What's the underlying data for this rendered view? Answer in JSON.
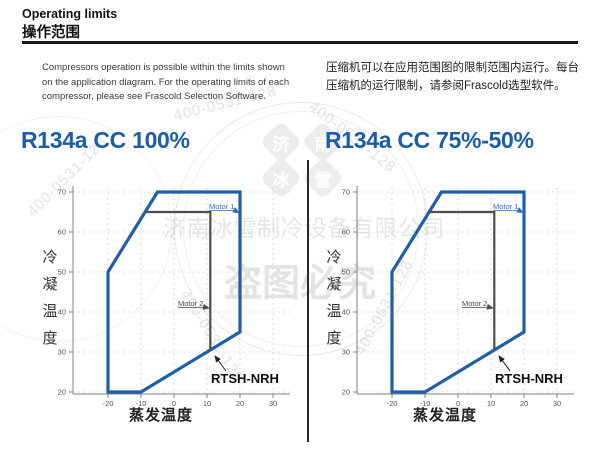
{
  "header": {
    "title_en": "Operating limits",
    "title_zh": "操作范围"
  },
  "intro": {
    "en": "Compressors operation is possible within the limits shown on the application diagram. For the operating limits of each compressor, please see Frascold Selection Software.",
    "zh": "压缩机可以在应用范围图的限制范围内运行。每台压缩机的运行限制，请参阅Frascold选型软件。"
  },
  "watermark": {
    "company": "济南冰雪制冷设备有限公司",
    "phone": "400-0531-128",
    "warning": "盗图必究",
    "logo_chars": [
      "济",
      "南",
      "冰",
      "雪"
    ]
  },
  "colors": {
    "accent_blue": "#1b5da8",
    "envelope_blue": "#1e5fa8",
    "motor1_blue": "#2f6fb8",
    "motor_gray": "#4d4d4d"
  },
  "chart_data": [
    {
      "type": "area",
      "title": "R134a CC 100%",
      "xlabel": "蒸发温度",
      "ylabel": "冷凝温度",
      "x_ticks": [
        -20,
        -10,
        0,
        10,
        20,
        30
      ],
      "y_ticks": [
        20,
        30,
        40,
        50,
        60,
        70
      ],
      "xlim": [
        -26,
        33
      ],
      "ylim": [
        18,
        72
      ],
      "grid": "dashed",
      "envelope": [
        [
          -20,
          20
        ],
        [
          -20,
          50
        ],
        [
          -5,
          70
        ],
        [
          20,
          70
        ],
        [
          20,
          35
        ],
        [
          -10,
          20
        ]
      ],
      "part_load_line": [
        [
          -8.75,
          65
        ],
        [
          11,
          65
        ],
        [
          11,
          30.5
        ]
      ],
      "labels": {
        "motor1": "Motor 1",
        "motor2": "Motor 2",
        "model": "RTSH-NRH"
      }
    },
    {
      "type": "area",
      "title": "R134a CC 75%-50%",
      "xlabel": "蒸发温度",
      "ylabel": "冷凝温度",
      "x_ticks": [
        -20,
        -10,
        0,
        10,
        20,
        30
      ],
      "y_ticks": [
        20,
        30,
        40,
        50,
        60,
        70
      ],
      "xlim": [
        -26,
        33
      ],
      "ylim": [
        18,
        72
      ],
      "grid": "dashed",
      "envelope": [
        [
          -20,
          20
        ],
        [
          -20,
          50
        ],
        [
          -5,
          70
        ],
        [
          20,
          70
        ],
        [
          20,
          35
        ],
        [
          -10,
          20
        ]
      ],
      "part_load_line": [
        [
          -8.75,
          65
        ],
        [
          11,
          65
        ],
        [
          11,
          30.5
        ]
      ],
      "labels": {
        "motor1": "Motor 1",
        "motor2": "Motor 2",
        "model": "RTSH-NRH"
      }
    }
  ]
}
